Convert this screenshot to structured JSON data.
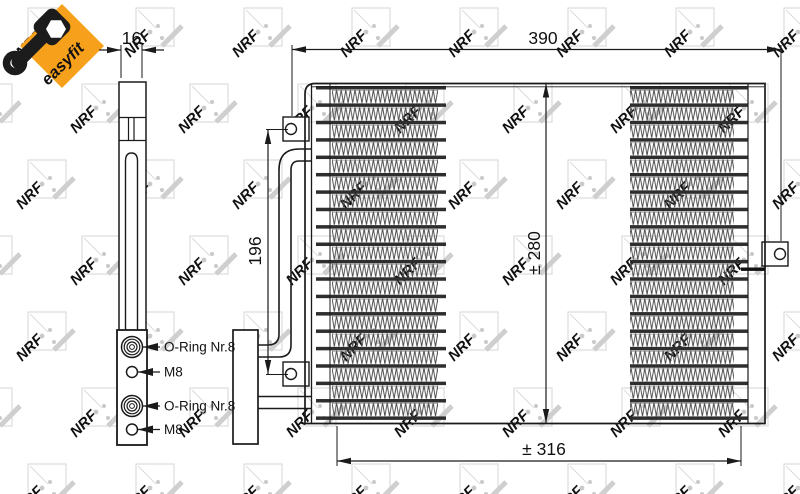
{
  "badge": {
    "label": "easyfit",
    "color": "#F7A01B",
    "icon": "wrench-icon"
  },
  "watermark": {
    "logo_text": "NRF"
  },
  "dimensions": {
    "side_depth": "16",
    "overall_width": "390",
    "bracket_span": "196",
    "core_height": "± 280",
    "mount_span": "± 316"
  },
  "callouts": [
    {
      "label": "O-Ring Nr.8"
    },
    {
      "label": "M8"
    },
    {
      "label": "O-Ring Nr.8"
    },
    {
      "label": "M8"
    }
  ],
  "drawing_colors": {
    "line": "#1a1a1a",
    "fin": "#4a4a4a",
    "tube": "#2e2e2e",
    "watermark_gray": "#c9c9c9",
    "badge_orange": "#F7A01B"
  }
}
